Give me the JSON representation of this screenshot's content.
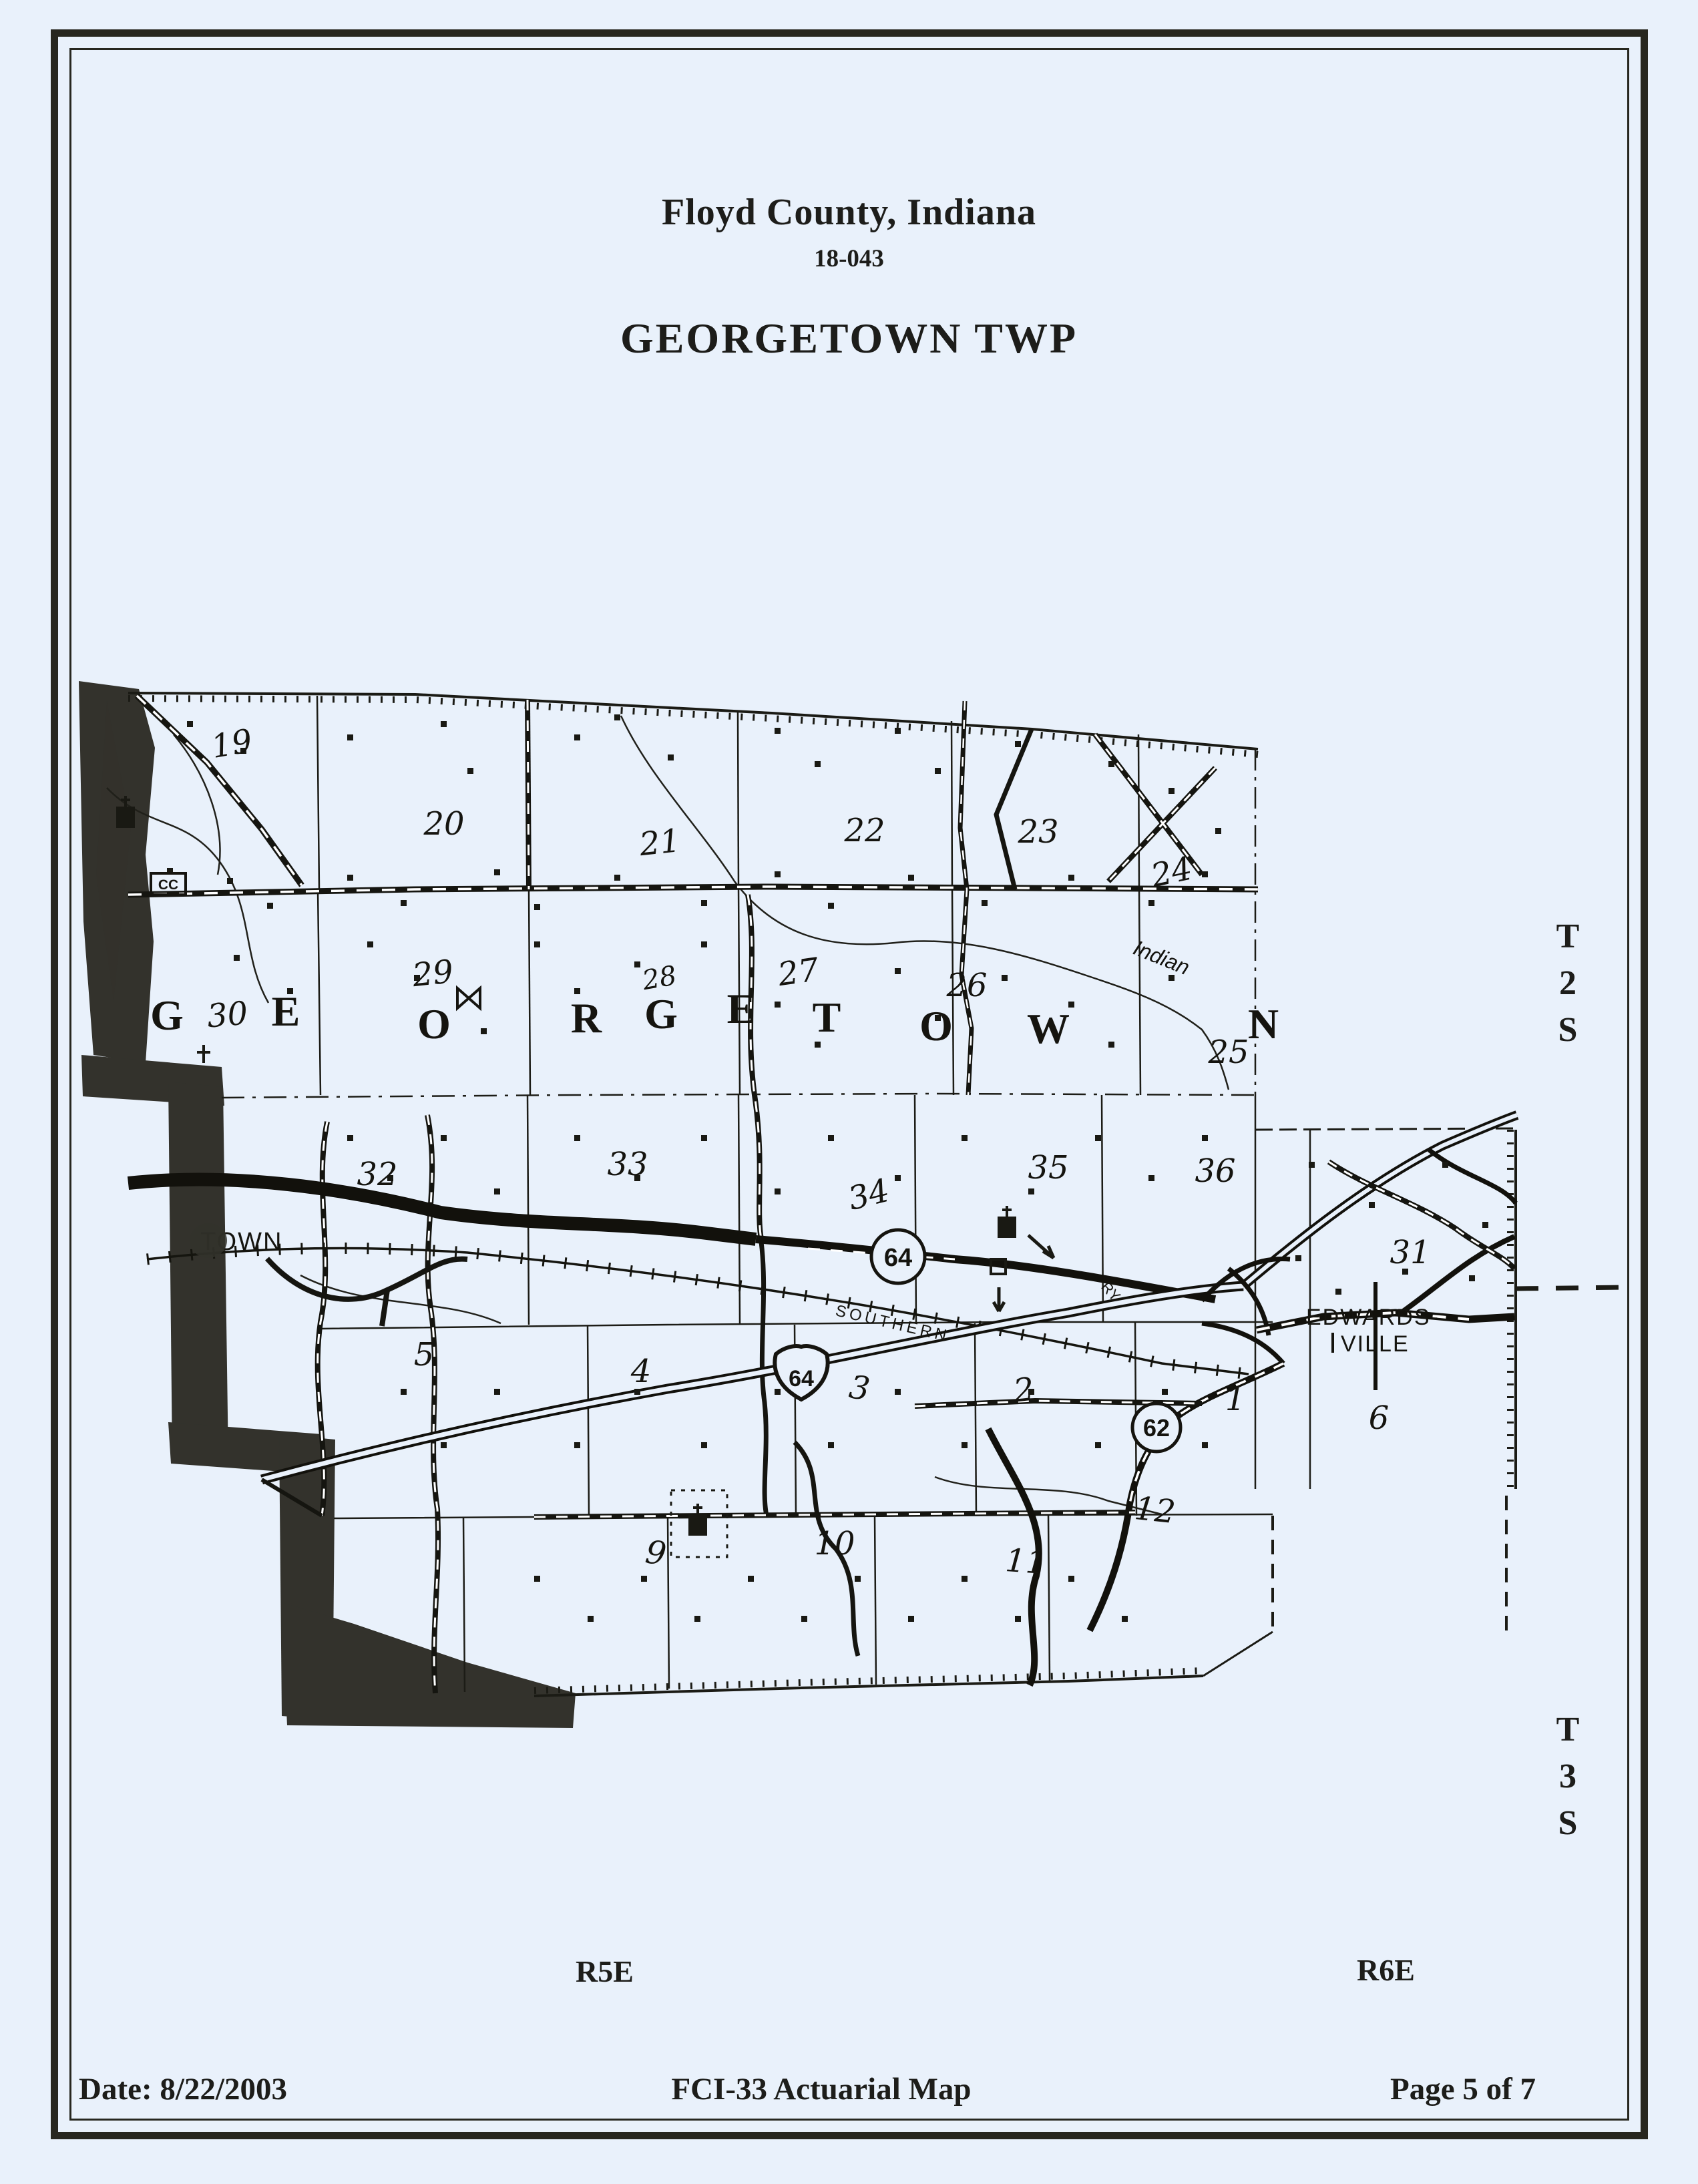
{
  "header": {
    "title": "Floyd County, Indiana",
    "code": "18-043",
    "township": "GEORGETOWN TWP"
  },
  "margins": {
    "t2s": "T\n2\nS",
    "t3s": "T\n3\nS",
    "r5e": "R5E",
    "r6e": "R6E"
  },
  "footer": {
    "date": "Date: 8/22/2003",
    "map_title": "FCI-33 Actuarial Map",
    "page": "Page 5 of 7"
  },
  "map": {
    "sections": [
      "19",
      "20",
      "21",
      "22",
      "23",
      "24",
      "25",
      "26",
      "27",
      "28",
      "29",
      "30",
      "31",
      "32",
      "33",
      "34",
      "35",
      "36",
      "1",
      "2",
      "3",
      "4",
      "5",
      "6",
      "9",
      "10",
      "11",
      "12"
    ],
    "letters": [
      "G",
      "E",
      "O",
      "R",
      "G",
      "E",
      "T",
      "O",
      "W",
      "N"
    ],
    "labels": {
      "indian": "Indian",
      "southern": "SOUTHERN",
      "ry": "RY",
      "edwardsville1": "EDWARDS-",
      "edwardsville2": "VILLE",
      "town": "TOWN",
      "cc": "CC"
    },
    "shields": {
      "i64": "64",
      "sr64": "64",
      "sr62": "62"
    }
  }
}
